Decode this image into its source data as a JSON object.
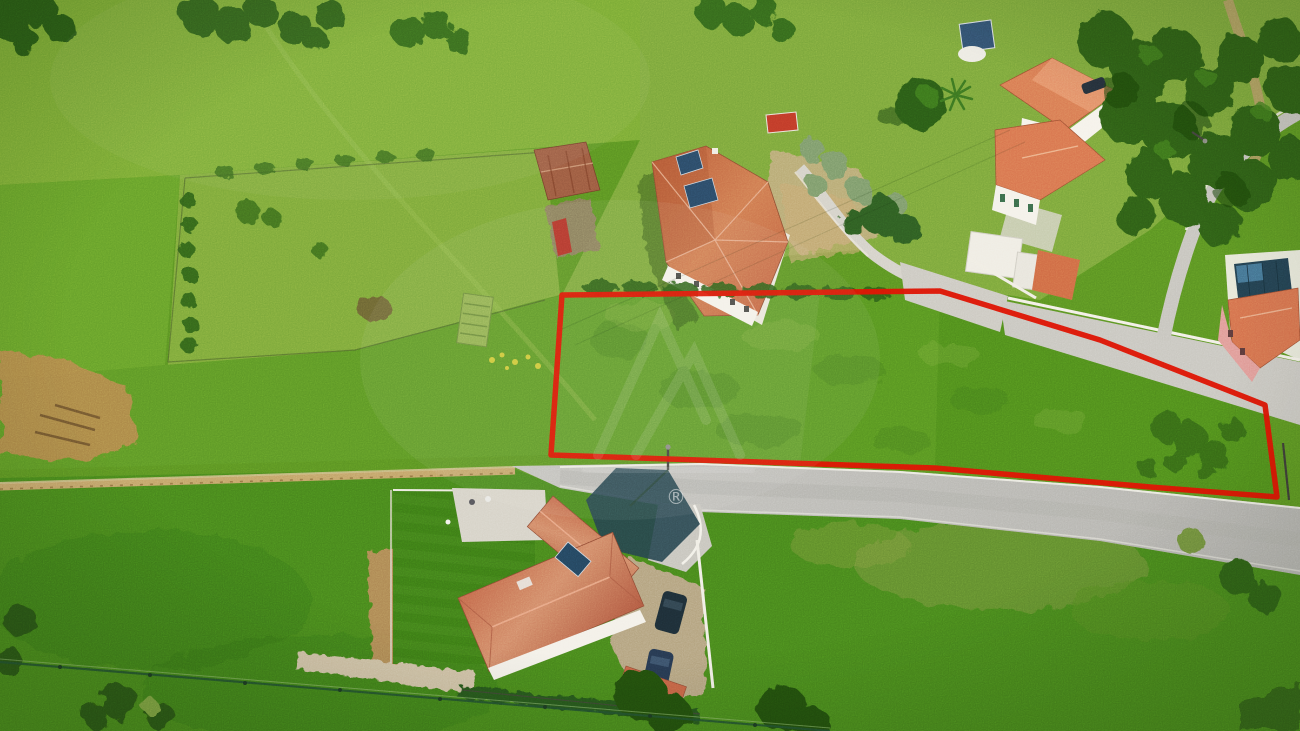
{
  "watermark": {
    "registered_symbol": "®"
  },
  "boundary": {
    "color": "#dc1404"
  },
  "palette": {
    "grass_base": "#5a9222",
    "grass_light": "#79aa35",
    "grass_dark": "#47851c",
    "tree": "#2d5d15",
    "road_asphalt": "#bab9b4",
    "dirt": "#bfa06a",
    "roof_terracotta": "#c86a48",
    "roof_orange": "#d87a52",
    "wall_white": "#f3f0e8",
    "solar_panel": "#28455e",
    "shadow": "#25414b",
    "car_dark": "#1d2d36",
    "car_blue": "#26384f",
    "lawn": "#3c7a16",
    "pink_house": "#e09a96"
  }
}
